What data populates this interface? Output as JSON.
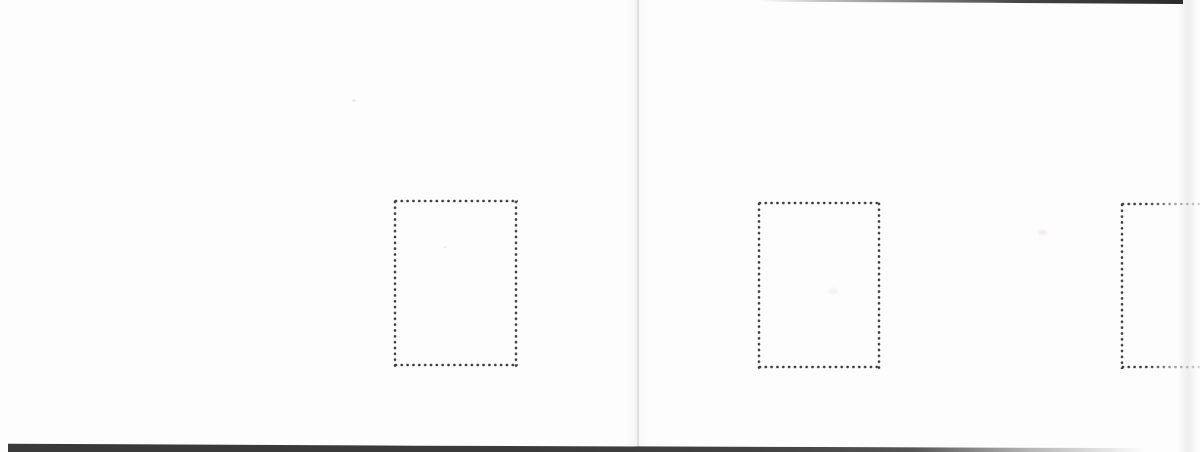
{
  "document": {
    "kind": "scanned spread of two blank album pages",
    "text_content": "",
    "pages": [
      {
        "id": "left-page",
        "stamp_mounts_visible": 1
      },
      {
        "id": "right-page",
        "stamp_mounts_visible": 2,
        "clipped_mounts": 1
      }
    ],
    "frames": [
      {
        "id": "stamp-frame-1",
        "style": "dotted-outline",
        "page": "left-page"
      },
      {
        "id": "stamp-frame-2",
        "style": "dotted-outline",
        "page": "right-page"
      },
      {
        "id": "stamp-frame-3",
        "style": "dotted-outline, cut off by right edge and fading",
        "page": "right-page"
      }
    ]
  },
  "colors": {
    "page_background": "#fdfdfd",
    "dot": "#3e3e3e",
    "bottom_shadow": "#3a3a3a",
    "top_shadow": "#343434",
    "gutter_line": "#d3cfd1"
  }
}
